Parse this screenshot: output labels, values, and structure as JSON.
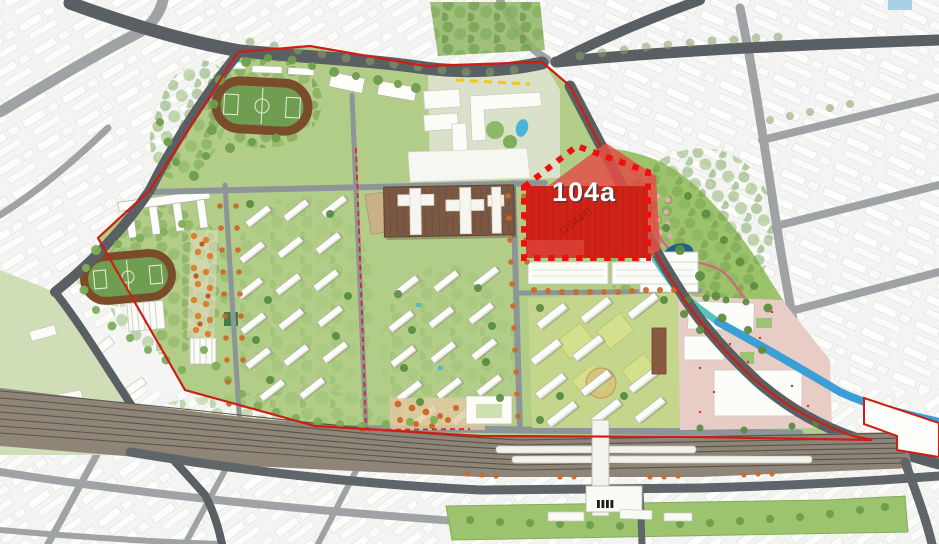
{
  "map": {
    "kind": "urban-masterplan-site-plan",
    "parcel": {
      "label": "104a",
      "watermark": "(104a#)"
    },
    "colors": {
      "highlight_red": "#d02317",
      "highlight_red_light": "#e25048",
      "dash_red": "#ee0f0f",
      "boundary_red": "#cf1d12",
      "phase_dash_red": "#e0251c",
      "canal_blue": "#3b9ed4",
      "park_teal": "#58c4bb",
      "pond_dark_blue": "#1f5f8a",
      "site_green": "#b2cd87",
      "park_green": "#9dc26c",
      "lawn_green": "#9cc46f",
      "track_brown": "#7a4c2c",
      "track_infield_green": "#6f9e50",
      "factory_brown": "#7b5844",
      "mall_paving_pink": "#e7cdc5",
      "road_dark": "#5c6165",
      "railway_brown": "#8e8478",
      "yellow_dash": "#f2c71c"
    },
    "features": [
      "site-boundary-red-line",
      "highlighted-parcel-104a",
      "running-track-north",
      "running-track-west",
      "school-buildings",
      "retained-factory-building",
      "residential-block-west",
      "residential-block-central",
      "residential-block-east",
      "shopping-mall-block",
      "riverside-park",
      "canal",
      "railway-corridor",
      "station-platforms",
      "station-footbridge",
      "station-building",
      "existing-city-context",
      "tree-lined-streets"
    ]
  }
}
